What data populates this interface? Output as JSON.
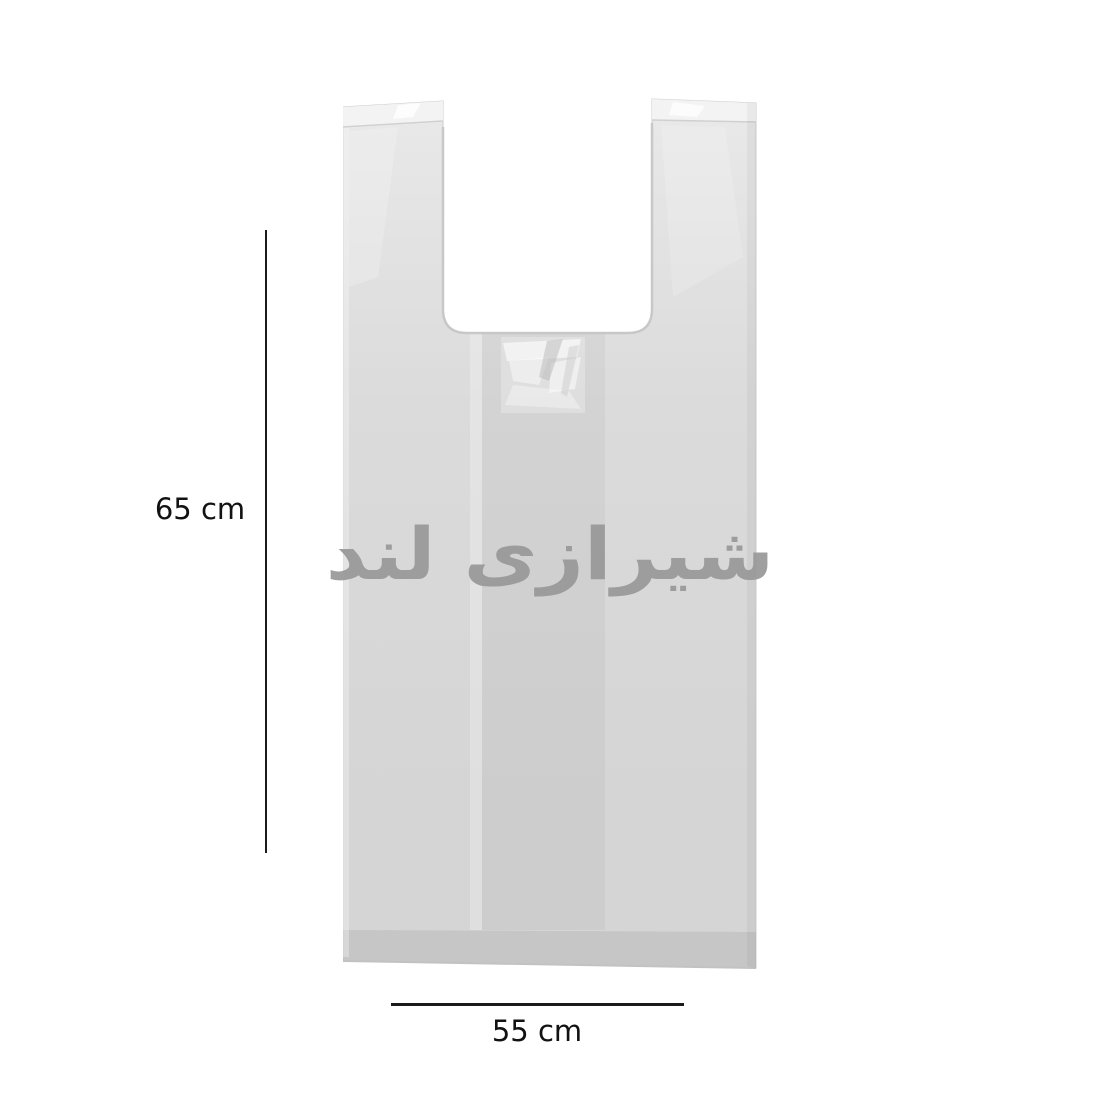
{
  "page": {
    "background": "#ffffff"
  },
  "bag": {
    "watermark_text": "شیرازی لند"
  },
  "measurements": {
    "height_label": "65 cm",
    "width_label": "55 cm"
  },
  "colors": {
    "background": "#ffffff",
    "dimension_line": "#1b1b1b",
    "label_text": "#121212",
    "bag_top": "#e9e9e9",
    "bag_mid": "#dbdbdb",
    "bag_low": "#d5d5d5",
    "fold_highlight": "#f3f3f3",
    "watermark_gray": "#9a9a9a",
    "panel_shade": "rgba(0,0,0,0.035)",
    "bottom_band": "rgba(0,0,0,0.07)",
    "edge_shade": "rgba(0,0,0,0.04)",
    "edge_line": "#cccccc"
  }
}
